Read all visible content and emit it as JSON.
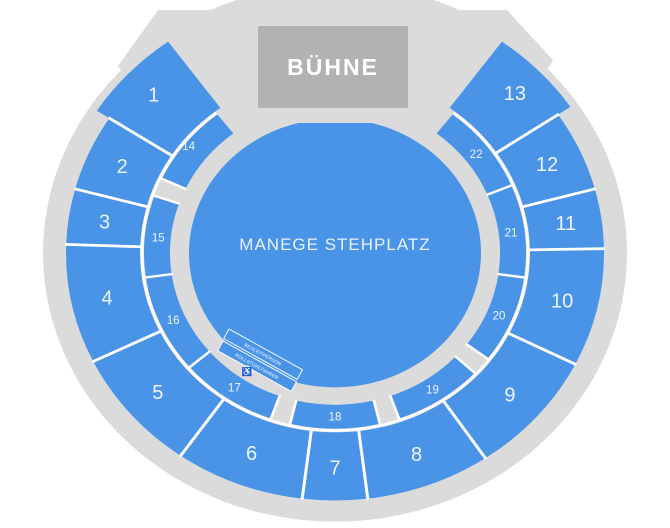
{
  "seat_map": {
    "stage_label": "BÜHNE",
    "floor_label": "MANEGE STEHPLATZ",
    "accessible": {
      "row1": "BEGLEITPERSON",
      "row2": "ROLLSTUHLFAHRER",
      "icon_glyph": "♿"
    },
    "colors": {
      "section": "#4a94e7",
      "venue": "#dbdbdb",
      "stage": "#b2b2b2",
      "separator": "#ffffff",
      "label": "#eef4fc"
    },
    "outer_sections": [
      {
        "label": "1",
        "start": 303,
        "end": 324,
        "label_r": 250,
        "r_out": 284
      },
      {
        "label": "2",
        "start": 285,
        "end": 303
      },
      {
        "label": "3",
        "start": 272,
        "end": 285
      },
      {
        "label": "4",
        "start": 244,
        "end": 272
      },
      {
        "label": "5",
        "start": 215,
        "end": 244
      },
      {
        "label": "6",
        "start": 187,
        "end": 215
      },
      {
        "label": "7",
        "start": 173,
        "end": 187
      },
      {
        "label": "8",
        "start": 146,
        "end": 173
      },
      {
        "label": "9",
        "start": 116.7,
        "end": 146
      },
      {
        "label": "10",
        "start": 89,
        "end": 116.7
      },
      {
        "label": "11",
        "start": 75,
        "end": 89
      },
      {
        "label": "12",
        "start": 56,
        "end": 75
      },
      {
        "label": "13",
        "start": 36,
        "end": 56,
        "label_r": 250,
        "r_out": 284
      }
    ],
    "inner_sections": [
      {
        "label": "14",
        "start": 295,
        "end": 322,
        "label_r": 187
      },
      {
        "label": "15",
        "start": 262,
        "end": 289
      },
      {
        "label": "16",
        "start": 229.5,
        "end": 262
      },
      {
        "label": "17",
        "start": 199.6,
        "end": 229.5
      },
      {
        "label": "18",
        "start": 166.4,
        "end": 193.6
      },
      {
        "label": "19",
        "start": 133,
        "end": 160.4
      },
      {
        "label": "20",
        "start": 98,
        "end": 127
      },
      {
        "label": "21",
        "start": 67.4,
        "end": 98
      },
      {
        "label": "22",
        "start": 38,
        "end": 67.4
      }
    ]
  }
}
